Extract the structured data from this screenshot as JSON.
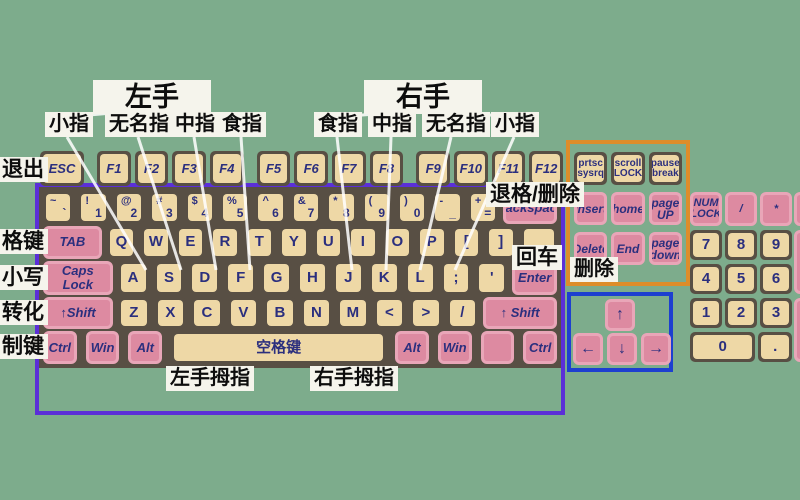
{
  "colors": {
    "background": "#7dac8c",
    "panel": "#584f44",
    "key_tan": "#eed8a6",
    "key_pink": "#dd8aa1",
    "key_pink_border": "#e9a6b8",
    "key_text": "#2b2f7e",
    "main_border": "#5b2fd8",
    "nav_border": "#dd8d2a",
    "arrow_border": "#1d3fd0",
    "label_bg": "#f5f4ec",
    "label_text": "#0d0d0d"
  },
  "hands": {
    "left": "左手",
    "right": "右手"
  },
  "fingers": {
    "left": [
      "小指",
      "无名指",
      "中指",
      "食指"
    ],
    "right": [
      "食指",
      "中指",
      "无名指",
      "小指"
    ]
  },
  "side_labels": [
    "退出",
    "格键",
    "小写",
    "转化",
    "制键"
  ],
  "callouts": {
    "backspace": "退格/删除",
    "enter": "回车",
    "delete": "删除",
    "left_thumb": "左手拇指",
    "right_thumb": "右手拇指"
  },
  "keyboard": {
    "esc_row": [
      {
        "t": "ESC",
        "n": "esc"
      }
    ],
    "function_groups": [
      [
        "F1",
        "F2",
        "F3",
        "F4"
      ],
      [
        "F5",
        "F6",
        "F7",
        "F8"
      ],
      [
        "F9",
        "F10",
        "F11",
        "F12"
      ]
    ],
    "rows": [
      [
        {
          "s": "~",
          "t": "`",
          "n": "tilde"
        },
        {
          "s": "!",
          "t": "1",
          "n": "1"
        },
        {
          "s": "@",
          "t": "2",
          "n": "2"
        },
        {
          "s": "#",
          "t": "3",
          "n": "3"
        },
        {
          "s": "$",
          "t": "4",
          "n": "4"
        },
        {
          "s": "%",
          "t": "5",
          "n": "5"
        },
        {
          "s": "^",
          "t": "6",
          "n": "6"
        },
        {
          "s": "&",
          "t": "7",
          "n": "7"
        },
        {
          "s": "*",
          "t": "8",
          "n": "8"
        },
        {
          "s": "(",
          "t": "9",
          "n": "9"
        },
        {
          "s": ")",
          "t": "0",
          "n": "0"
        },
        {
          "s": "-",
          "t": "_",
          "n": "minus"
        },
        {
          "s": "+",
          "t": "=",
          "n": "plus"
        },
        {
          "t": "Backspace",
          "n": "backspace",
          "c": "pink",
          "w": 2.2
        }
      ],
      [
        {
          "t": "TAB",
          "n": "tab",
          "c": "pink",
          "w": 2.5
        },
        "Q",
        "W",
        "E",
        "R",
        "T",
        "Y",
        "U",
        "I",
        "O",
        "P",
        {
          "t": "[",
          "n": "bracket-left"
        },
        {
          "t": "]",
          "n": "bracket-right"
        },
        {
          "t": "",
          "n": "backslash-blank",
          "w": 1.3
        }
      ],
      [
        {
          "t": "Caps Lock",
          "n": "caps-lock",
          "c": "pink",
          "w": 2.8
        },
        "A",
        "S",
        "D",
        "F",
        "G",
        "H",
        "J",
        "K",
        "L",
        {
          "t": ";",
          "n": "semicolon"
        },
        {
          "t": "'",
          "n": "quote"
        },
        {
          "t": "Enter",
          "n": "enter",
          "c": "pink",
          "w": 1.8
        }
      ],
      [
        {
          "t": "↑Shift",
          "n": "shift-left",
          "c": "pink",
          "w": 2.75
        },
        "Z",
        "X",
        "C",
        "V",
        "B",
        "N",
        "M",
        {
          "t": "<",
          "n": "less-than"
        },
        {
          "t": ">",
          "n": "greater-than"
        },
        {
          "t": "/",
          "n": "slash"
        },
        {
          "t": "↑ Shift",
          "n": "shift-right",
          "c": "pink",
          "w": 2.9
        }
      ],
      [
        {
          "t": "Ctrl",
          "n": "ctrl-left",
          "c": "pink"
        },
        {
          "t": "Win",
          "n": "win-left",
          "c": "pink"
        },
        {
          "t": "Alt",
          "n": "alt-left",
          "c": "pink"
        },
        {
          "t": "空格键",
          "n": "space",
          "w": 6.2
        },
        {
          "t": "Alt",
          "n": "alt-right",
          "c": "pink"
        },
        {
          "t": "Win",
          "n": "win-right",
          "c": "pink"
        },
        {
          "t": "",
          "n": "menu-blank",
          "c": "pink"
        },
        {
          "t": "Ctrl",
          "n": "ctrl-right",
          "c": "pink"
        }
      ]
    ]
  },
  "nav_cluster": {
    "rows": [
      [
        {
          "t": "prtsc\nsysrq",
          "n": "print-screen"
        },
        {
          "t": "scroll\nLOCK",
          "n": "scroll-lock"
        },
        {
          "t": "pause\nbreak",
          "n": "pause-break"
        }
      ],
      [
        {
          "t": "Insert",
          "n": "insert",
          "c": "pink"
        },
        {
          "t": "home",
          "n": "home",
          "c": "pink"
        },
        {
          "t": "page\nUP",
          "n": "page-up",
          "c": "pink"
        }
      ],
      [
        {
          "t": "Delete",
          "n": "delete",
          "c": "pink"
        },
        {
          "t": "End",
          "n": "end",
          "c": "pink"
        },
        {
          "t": "page\ndown",
          "n": "page-down",
          "c": "pink"
        }
      ]
    ]
  },
  "numpad": {
    "rows": [
      [
        {
          "t": "NUM\nLOCK",
          "n": "num-lock",
          "c": "pink"
        },
        {
          "t": "/",
          "n": "num-divide",
          "c": "pink"
        },
        {
          "t": "*",
          "n": "num-multiply",
          "c": "pink"
        }
      ],
      [
        {
          "t": "7",
          "n": "num-7"
        },
        {
          "t": "8",
          "n": "num-8"
        },
        {
          "t": "9",
          "n": "num-9"
        }
      ],
      [
        {
          "t": "4",
          "n": "num-4"
        },
        {
          "t": "5",
          "n": "num-5"
        },
        {
          "t": "6",
          "n": "num-6"
        }
      ],
      [
        {
          "t": "1",
          "n": "num-1"
        },
        {
          "t": "2",
          "n": "num-2"
        },
        {
          "t": "3",
          "n": "num-3"
        }
      ],
      [
        {
          "t": "0",
          "n": "num-0",
          "w": 2.15
        },
        {
          "t": ".",
          "n": "num-dot"
        }
      ]
    ]
  },
  "arrows": {
    "up": "↑",
    "left": "←",
    "down": "↓",
    "right": "→"
  }
}
